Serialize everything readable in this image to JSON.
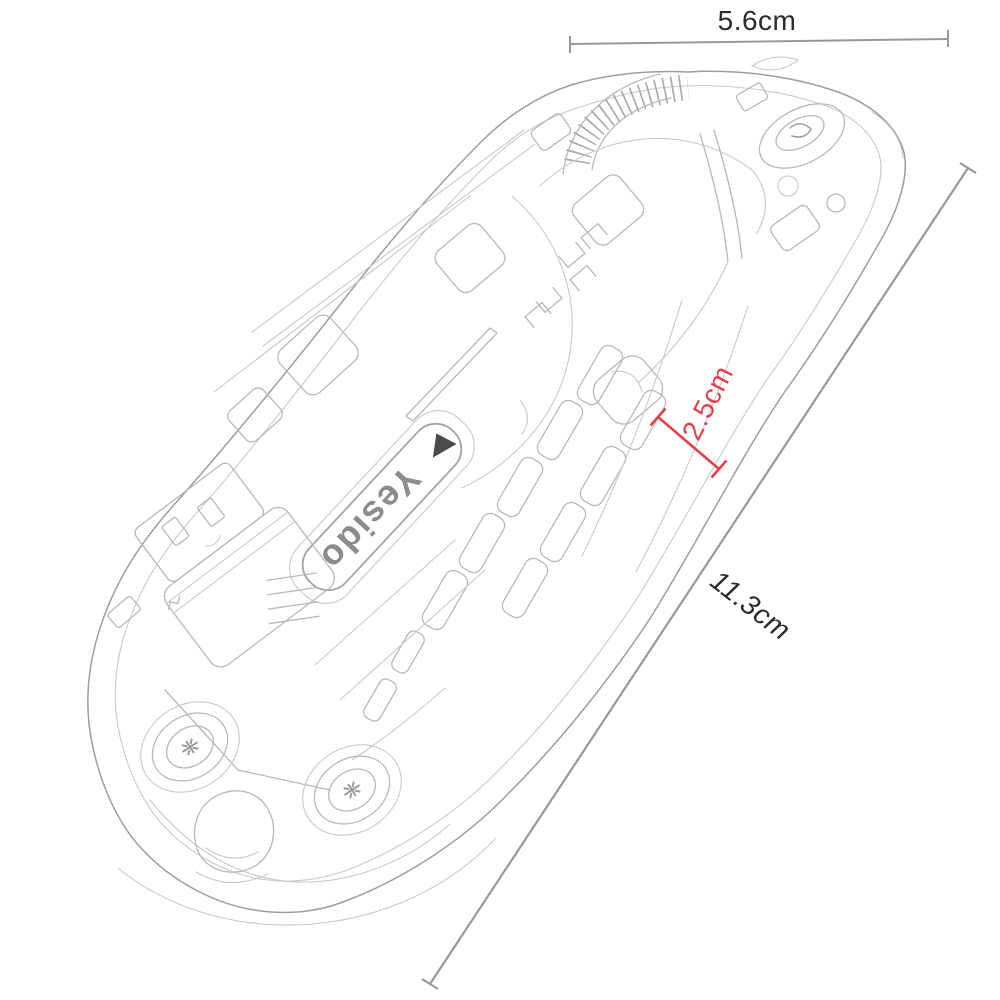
{
  "diagram": {
    "brand_logo": "Yesido",
    "dimensions": {
      "top_width": "5.6cm",
      "side_length": "11.3cm",
      "inner_width": "2.5cm"
    }
  },
  "colors": {
    "background": "#ffffff",
    "sketch_line": "#b8b8b8",
    "sketch_line_light": "#c9c9c9",
    "sketch_line_dark": "#9d9d9d",
    "dimension_line": "#96999c",
    "dimension_text": "#2b2b2b",
    "accent_red": "#e23f49",
    "brand_text": "#8c8c8c",
    "brand_mark": "#4b4b4b"
  }
}
